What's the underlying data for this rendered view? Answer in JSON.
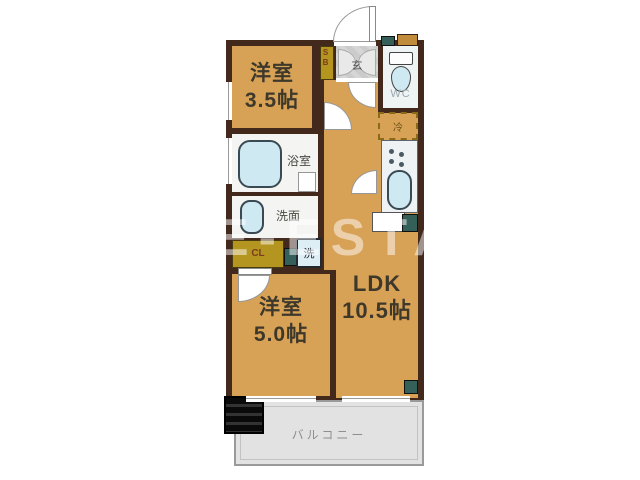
{
  "watermark": "SALE-ESTATE",
  "rooms": {
    "west_room_1": {
      "name": "洋室",
      "size": "3.5帖"
    },
    "west_room_2": {
      "name": "洋室",
      "size": "5.0帖"
    },
    "ldk": {
      "name": "LDK",
      "size": "10.5帖"
    },
    "bathroom": {
      "label": "浴室"
    },
    "washroom": {
      "label": "洗面"
    },
    "toilet": {
      "label": "WC"
    },
    "entrance": {
      "label": "玄"
    },
    "shoe_box": {
      "label": "SB"
    },
    "closet": {
      "label": "CL"
    },
    "washer": {
      "label": "洗"
    },
    "refrigerator": {
      "label": "冷"
    },
    "balcony": {
      "label": "バルコニー"
    }
  },
  "colors": {
    "floor": "#d7a156",
    "wall": "#42291c",
    "fixture_blue": "#cfe9f2",
    "cabinet_olive": "#b4951f",
    "teal_unit": "#35605a",
    "balcony_gray": "#e2e2e2",
    "watermark_white": "#ffffff"
  }
}
